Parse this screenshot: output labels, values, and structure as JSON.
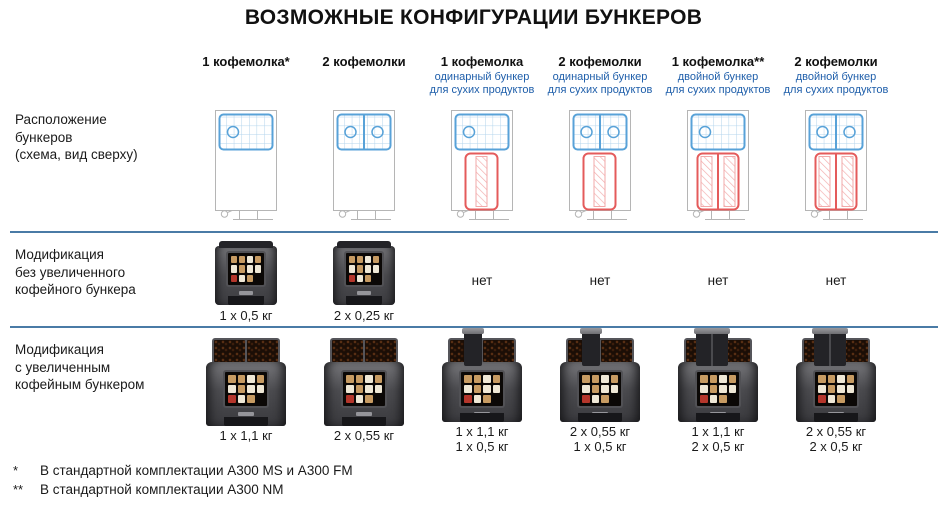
{
  "title": "ВОЗМОЖНЫЕ КОНФИГУРАЦИИ БУНКЕРОВ",
  "colors": {
    "header_subtitle_blue": "#1e5eaa",
    "divider_blue": "#4a7ba6",
    "schematic_outline_gray": "#b5b5b5",
    "schematic_coffee_blue": "#58a2d8",
    "schematic_dry_red": "#e45b5b"
  },
  "rows": {
    "layout": {
      "label": "Расположение\nбункеров\n(схема, вид сверху)"
    },
    "standard": {
      "label": "Модификация\nбез увеличенного\nкофейного бункера"
    },
    "enlarged": {
      "label": "Модификация\nс увеличенным\nкофейным бункером"
    }
  },
  "columns": [
    {
      "title": "1 кофемолка*",
      "schematic": {
        "coffee_hoppers": 1,
        "dry_product_hopper": "none"
      },
      "standard": {
        "available": true,
        "caption": "1 х 0,5 кг"
      },
      "enlarged": {
        "lines": [
          "1 х 1,1 кг"
        ]
      }
    },
    {
      "title": "2 кофемолки",
      "schematic": {
        "coffee_hoppers": 2,
        "dry_product_hopper": "none"
      },
      "standard": {
        "available": true,
        "caption": "2 х 0,25 кг"
      },
      "enlarged": {
        "lines": [
          "2 х 0,55 кг"
        ]
      }
    },
    {
      "title": "1 кофемолка",
      "subtitle": "одинарный бункер\nдля сухих продуктов",
      "schematic": {
        "coffee_hoppers": 1,
        "dry_product_hopper": "single"
      },
      "standard": {
        "available": false,
        "caption": "нет"
      },
      "enlarged": {
        "lines": [
          "1 х 1,1 кг",
          "1 х 0,5 кг"
        ]
      }
    },
    {
      "title": "2 кофемолки",
      "subtitle": "одинарный бункер\nдля сухих продуктов",
      "schematic": {
        "coffee_hoppers": 2,
        "dry_product_hopper": "single"
      },
      "standard": {
        "available": false,
        "caption": "нет"
      },
      "enlarged": {
        "lines": [
          "2 х 0,55 кг",
          "1 х 0,5 кг"
        ]
      }
    },
    {
      "title": "1 кофемолка**",
      "subtitle": "двойной бункер\nдля сухих продуктов",
      "schematic": {
        "coffee_hoppers": 1,
        "dry_product_hopper": "double"
      },
      "standard": {
        "available": false,
        "caption": "нет"
      },
      "enlarged": {
        "lines": [
          "1 х 1,1 кг",
          "2 х 0,5 кг"
        ]
      }
    },
    {
      "title": "2 кофемолки",
      "subtitle": "двойной бункер\nдля сухих продуктов",
      "schematic": {
        "coffee_hoppers": 2,
        "dry_product_hopper": "double"
      },
      "standard": {
        "available": false,
        "caption": "нет"
      },
      "enlarged": {
        "lines": [
          "2 х 0,55 кг",
          "2 х 0,5 кг"
        ]
      }
    }
  ],
  "footnotes": [
    {
      "marker": "*",
      "text": "В стандартной комплектации A300 MS и A300 FM"
    },
    {
      "marker": "**",
      "text": "В стандартной комплектации A300 NM"
    }
  ]
}
